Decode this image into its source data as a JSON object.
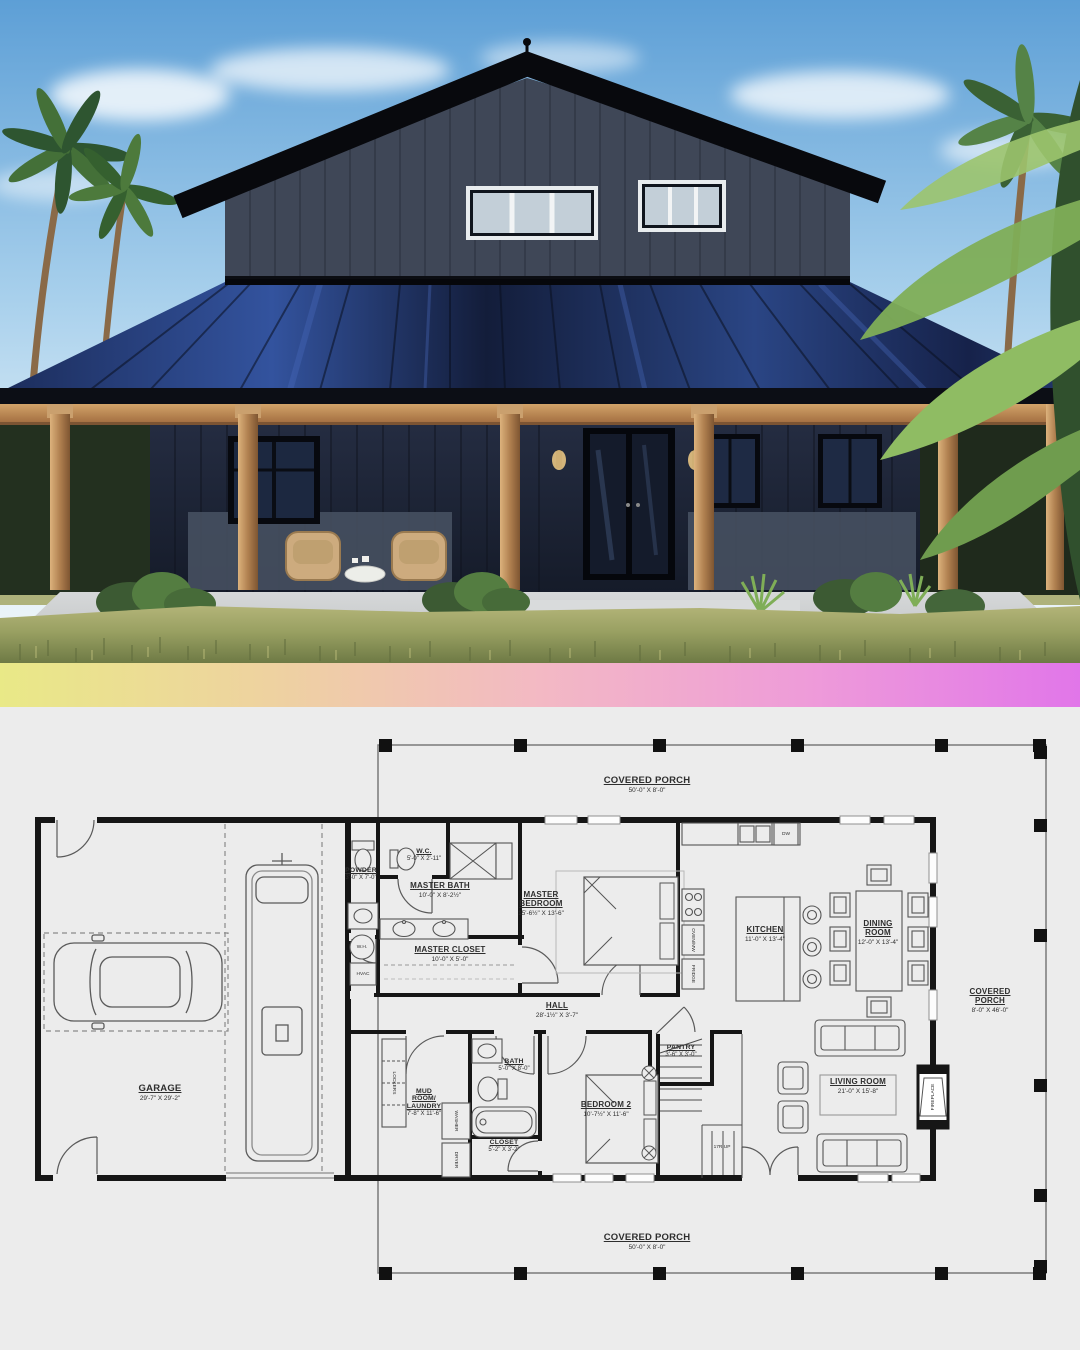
{
  "divider": {
    "gradient": [
      "#e9e987",
      "#eed2a0",
      "#f3b9c4",
      "#ee9bd9",
      "#e176e9"
    ]
  },
  "plan": {
    "background": "#ececec",
    "porch_top": {
      "name": "COVERED PORCH",
      "dims": "50'-0\" X 8'-0\""
    },
    "porch_right": {
      "name": "COVERED PORCH",
      "dims": "8'-0\" X 46'-0\""
    },
    "porch_bottom": {
      "name": "COVERED PORCH",
      "dims": "50'-0\" X 8'-0\""
    },
    "rooms": {
      "garage": {
        "name": "GARAGE",
        "dims": "29'-7\" X 29'-2\""
      },
      "powder": {
        "name": "POWDER",
        "dims": "3'-0\" X 7'-0\""
      },
      "wc": {
        "name": "W.C.",
        "dims": "5'-0\" X 2'-11\""
      },
      "master_bath": {
        "name": "MASTER BATH",
        "dims": "10'-0\" X 8'-2½\""
      },
      "master_closet": {
        "name": "MASTER CLOSET",
        "dims": "10'-0\" X 5'-0\""
      },
      "master_bedroom": {
        "name": "MASTER BEDROOM",
        "dims": "15'-6½\" X 13'-6\""
      },
      "kitchen": {
        "name": "KITCHEN",
        "dims": "11'-0\" X 13'-4\""
      },
      "dining_room": {
        "name": "DINING ROOM",
        "dims": "12'-0\" X 13'-4\""
      },
      "hall": {
        "name": "HALL",
        "dims": "28'-1½\" X 3'-7\""
      },
      "pantry": {
        "name": "PANTRY",
        "dims": "3'-6\" X 3'-0\""
      },
      "bath": {
        "name": "BATH",
        "dims": "5'-0\" X 8'-0\""
      },
      "bedroom_2": {
        "name": "BEDROOM 2",
        "dims": "10'-7½\" X 11'-6\""
      },
      "mud_room_laundry": {
        "name": "MUD ROOM/ LAUNDRY",
        "dims": "7'-8\" X 11'-6\""
      },
      "closet": {
        "name": "CLOSET",
        "dims": "5'-2\" X 3'-2\""
      },
      "living_room": {
        "name": "LIVING ROOM",
        "dims": "21'-0\" X 15'-8\""
      }
    },
    "fixtures": {
      "water_heater": "W.H.",
      "hvac": "HVAC",
      "dishwasher": "DW",
      "stairs": "17R UP",
      "lockers": "LOCKERS",
      "washer": "WASHER",
      "dryer": "DRYER",
      "oven": "OVEN/MW",
      "fridge": "FRIDGE",
      "fireplace": "FIREPLACE"
    }
  }
}
